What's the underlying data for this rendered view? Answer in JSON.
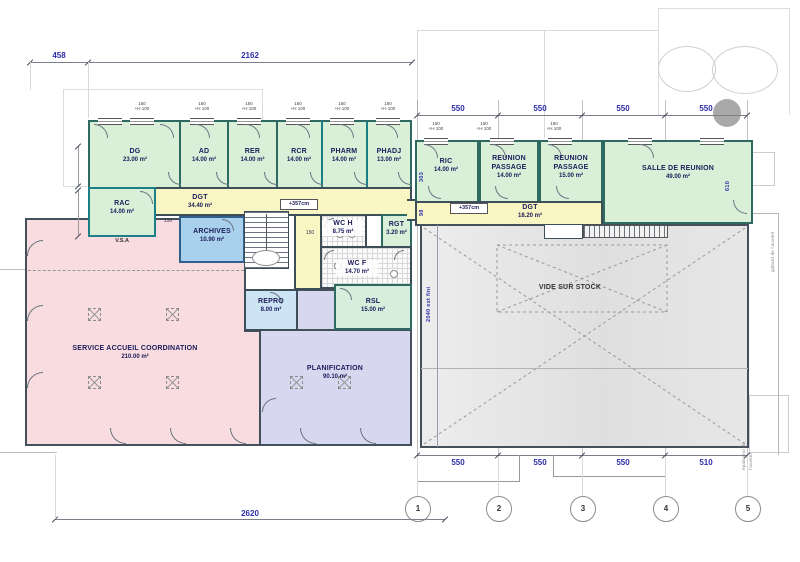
{
  "plan": {
    "rooms": {
      "dg": {
        "name": "DG",
        "area": "23.00 m²"
      },
      "ad": {
        "name": "AD",
        "area": "14.00 m²"
      },
      "rer": {
        "name": "RER",
        "area": "14.00 m²"
      },
      "rcr": {
        "name": "RCR",
        "area": "14.00 m²"
      },
      "pharm": {
        "name": "PHARM",
        "area": "14.00 m²"
      },
      "phadj": {
        "name": "PHADJ",
        "area": "13.00 m²"
      },
      "rac": {
        "name": "RAC",
        "area": "14.00 m²"
      },
      "dgt1": {
        "name": "DGT",
        "area": "34.40 m²"
      },
      "archives": {
        "name": "ARCHIVES",
        "area": "10.90 m²"
      },
      "wch": {
        "name": "WC H",
        "area": "8.75 m²"
      },
      "rgt": {
        "name": "RGT",
        "area": "3.20 m²"
      },
      "wcf": {
        "name": "WC F",
        "area": "14.70 m²"
      },
      "repro": {
        "name": "REPRO",
        "area": "8.00 m²"
      },
      "rsl": {
        "name": "RSL",
        "area": "15.00 m²"
      },
      "sac": {
        "name": "SERVICE ACCUEIL COORDINATION",
        "area": "210.00 m²"
      },
      "plan": {
        "name": "PLANIFICATION",
        "area": "90.10 m²"
      },
      "ric": {
        "name": "RIC",
        "area": "14.00 m²"
      },
      "rp1": {
        "name": "REUNION PASSAGE",
        "area": "14.00 m²"
      },
      "rp2": {
        "name": "REUNION PASSAGE",
        "area": "15.00 m²"
      },
      "salle": {
        "name": "SALLE DE REUNION",
        "area": "49.00 m²"
      },
      "dgt2": {
        "name": "DGT",
        "area": "18.20 m²"
      },
      "vide": {
        "name": "VIDE SUR STOCK"
      }
    },
    "dims": {
      "top_left_1": "458",
      "top_left_2": "2162",
      "top_right": [
        "550",
        "550",
        "550",
        "550"
      ],
      "bottom_right": [
        "550",
        "550",
        "550",
        "510"
      ],
      "bottom": "2620",
      "small_150a": "150",
      "small_150b": "150",
      "v303": "303",
      "v98": "98",
      "v610": "610"
    },
    "grid": {
      "bubbles": [
        "1",
        "2",
        "3",
        "4",
        "5"
      ]
    },
    "annotations": {
      "level": "+357cm",
      "vsa": "V.S.A",
      "ext_fini": "2040 ext fini",
      "auvent_side": "gabarit de l'auvent",
      "auvent_b1": "epaisseur de",
      "auvent_b2": "l'auvent"
    },
    "window_tag": {
      "line1": "160",
      "line2": "+H 100"
    },
    "colors": {
      "green": "#d9efd7",
      "yellow": "#faf6c4",
      "pink": "#f8dcdf",
      "lavender": "#d7d7f0",
      "archives_blue": "#a9d1ee",
      "stock_gray": "#e6e6e6",
      "dim_blue": "#2e2ea8"
    }
  }
}
